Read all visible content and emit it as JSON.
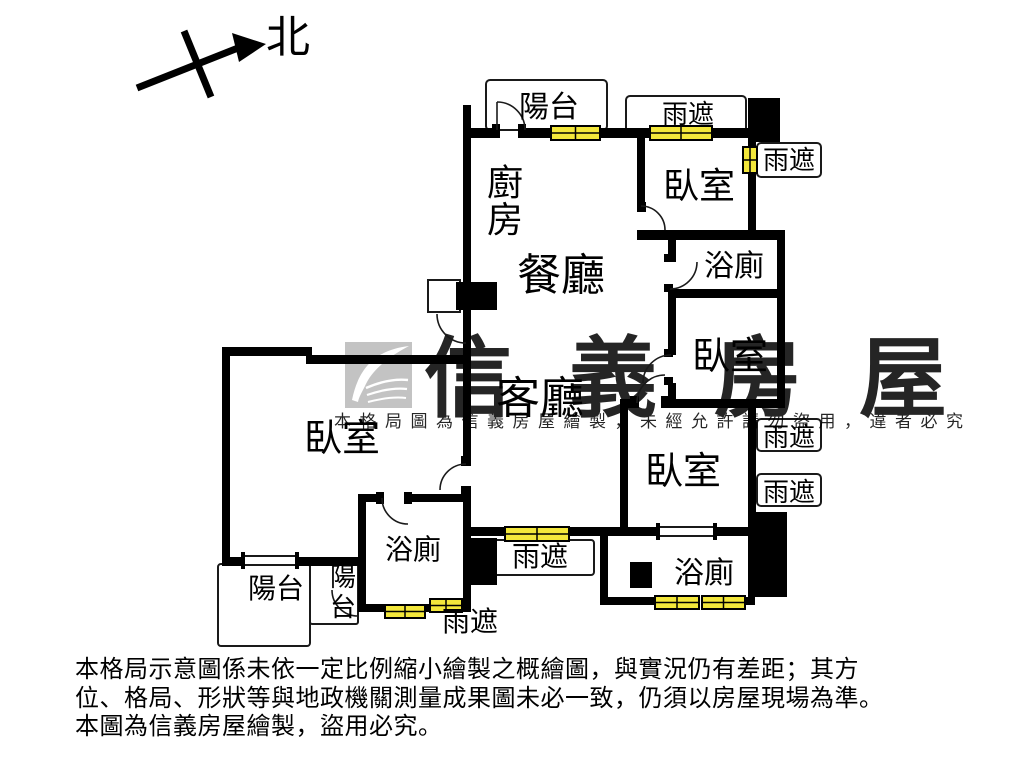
{
  "compass": {
    "north": "北"
  },
  "labels": {
    "balcony": "陽台",
    "canopy": "雨遮",
    "kitchen": "廚房",
    "dining": "餐廳",
    "living_room": "客廳",
    "bedroom": "臥室",
    "bathroom": "浴廁"
  },
  "watermark": {
    "brand": "信義房屋",
    "notice": "本格局圖為信義房屋繪製，未經允許請勿盜用，違者必究"
  },
  "disclaimer": {
    "line1": "本格局示意圖係未依一定比例縮小繪製之概繪圖，與實況仍有差距；其方",
    "line2": "位、格局、形狀等與地政機關測量成果圖未必一致，仍須以房屋現場為準。",
    "line3": "本圖為信義房屋繪製，盜用必究。"
  },
  "colors": {
    "wall": "#000000",
    "window": "#f3e73b",
    "watermark": "#b3b3b3",
    "background": "#ffffff"
  }
}
